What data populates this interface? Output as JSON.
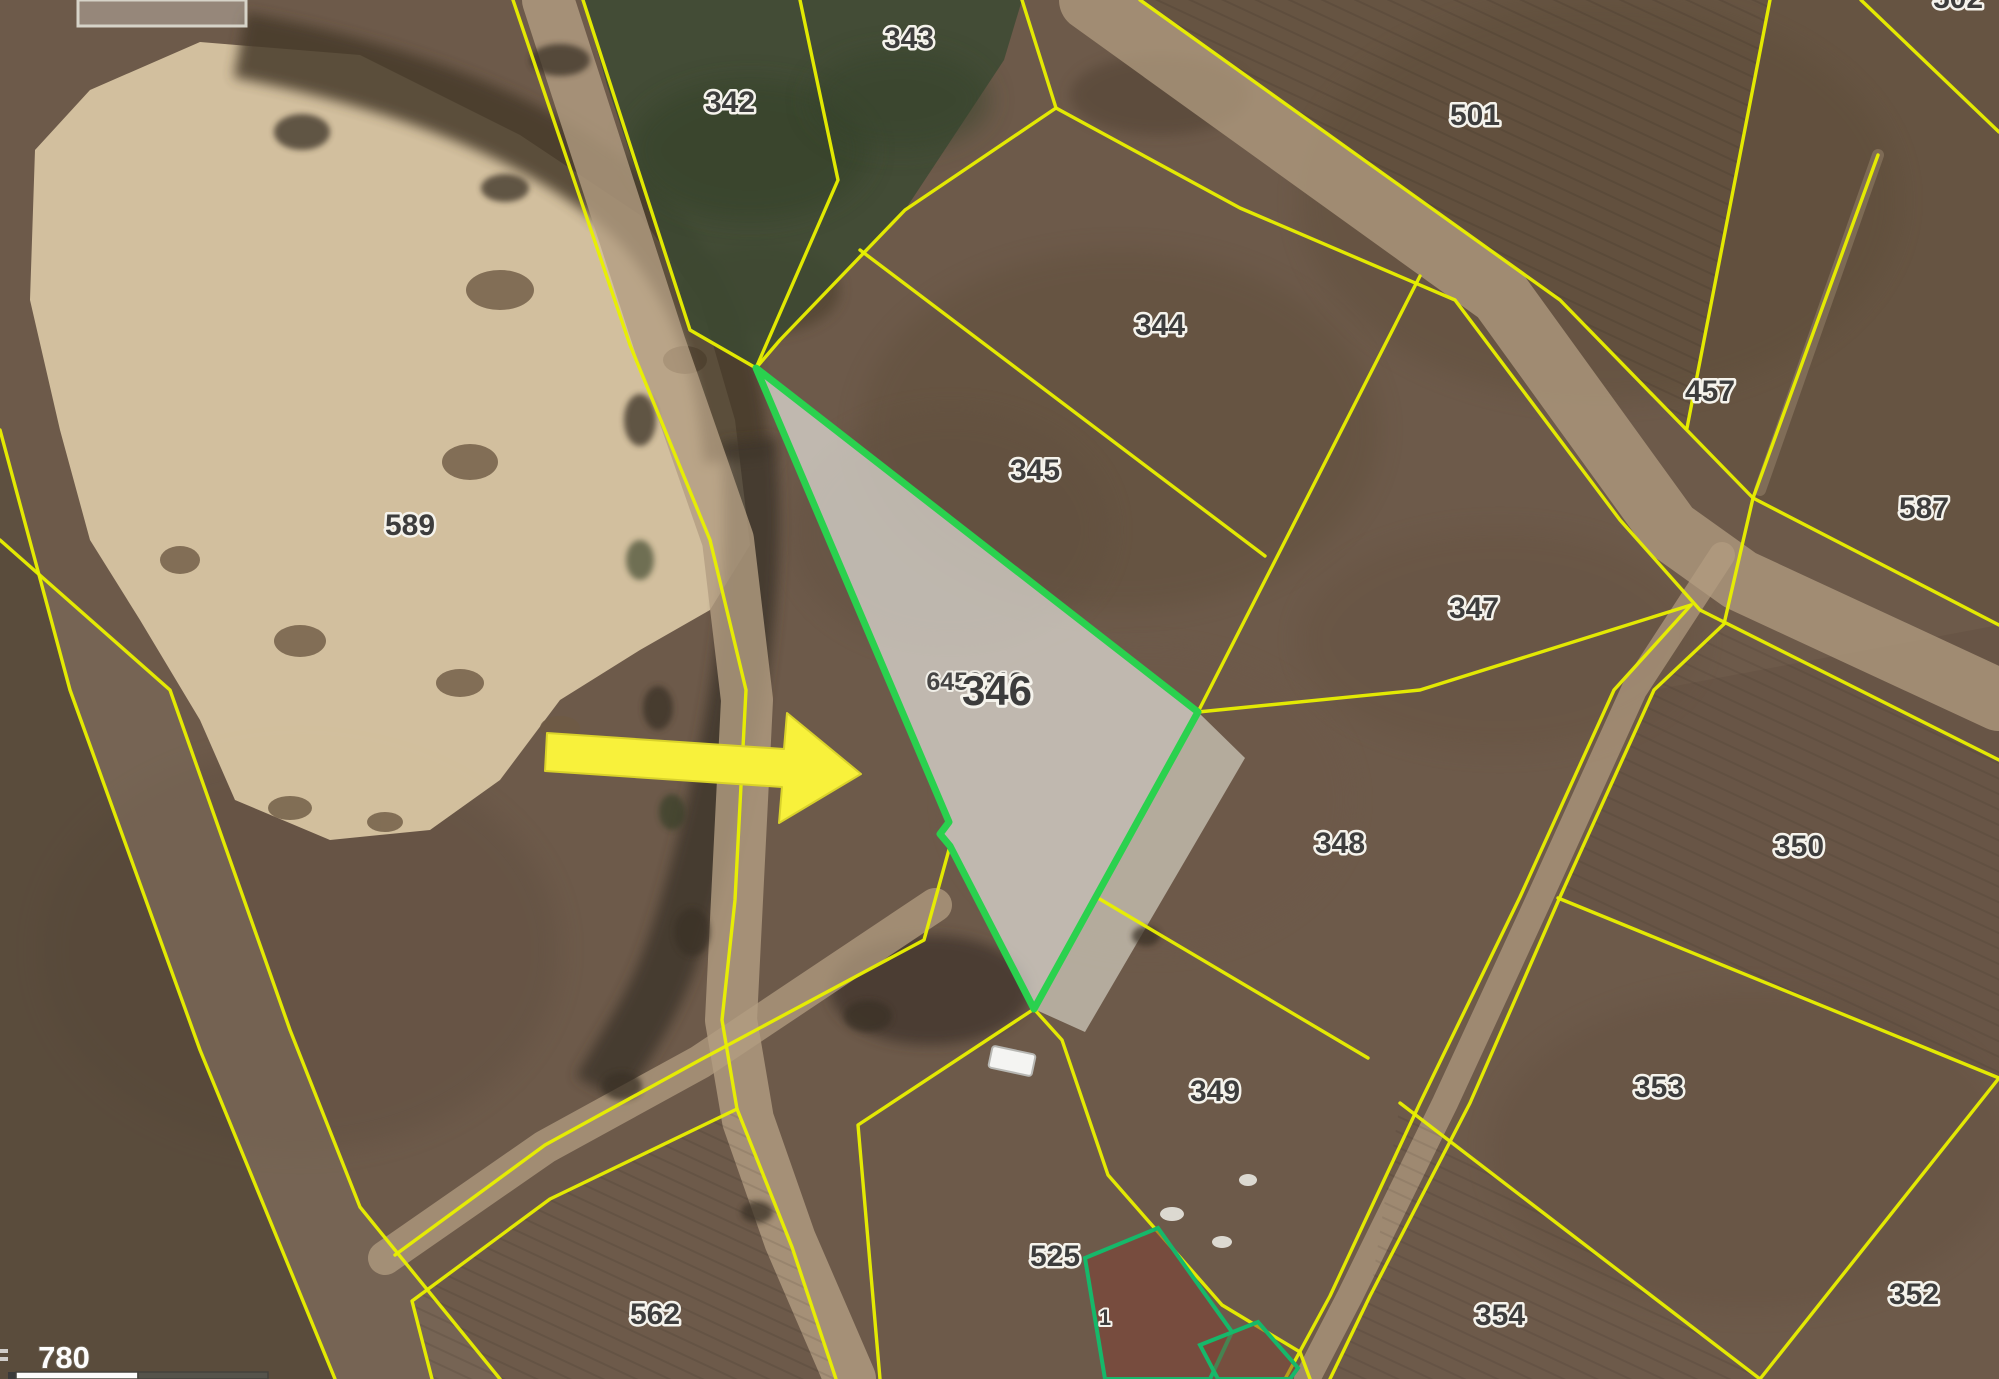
{
  "map": {
    "type": "cadastral-aerial-map",
    "line_color": "#e8ef00",
    "highlight": {
      "parcel_label": "346",
      "parcel_id_label": "6453313",
      "outline_color": "#2ad14e",
      "fill_color": "rgba(235,233,227,0.66)"
    },
    "parcels": [
      {
        "label": "342"
      },
      {
        "label": "343"
      },
      {
        "label": "344"
      },
      {
        "label": "345"
      },
      {
        "label": "347"
      },
      {
        "label": "348"
      },
      {
        "label": "349"
      },
      {
        "label": "350"
      },
      {
        "label": "352"
      },
      {
        "label": "353"
      },
      {
        "label": "354"
      },
      {
        "label": "457"
      },
      {
        "label": "501"
      },
      {
        "label": "525"
      },
      {
        "label": "562"
      },
      {
        "label": "587"
      },
      {
        "label": "589"
      }
    ],
    "building": {
      "label": "1",
      "outline_color": "#16b86a"
    },
    "partial_parcel_label": "502",
    "annotation_arrow": {
      "shape": "arrow-right",
      "color": "#f8f13b"
    },
    "scale": {
      "text": "780"
    }
  }
}
